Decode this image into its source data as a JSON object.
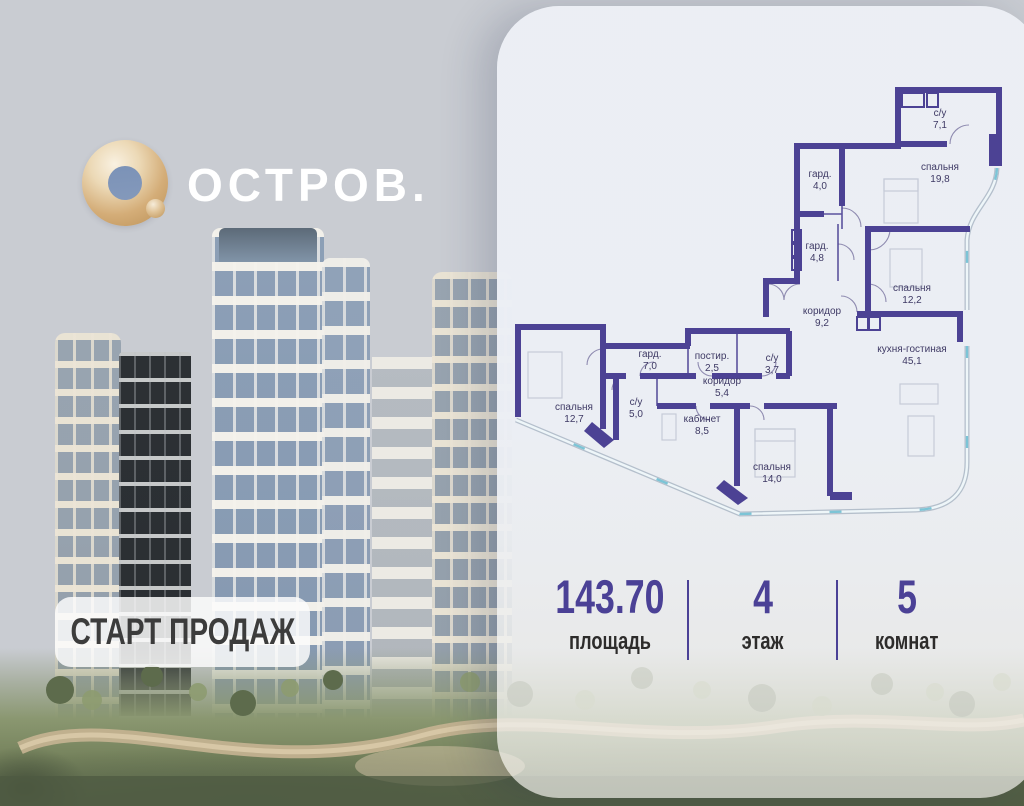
{
  "logo": {
    "brand_mark": "О.",
    "brand_name": "ОСТРОВ."
  },
  "badge": {
    "label": "СТАРТ ПРОДАЖ"
  },
  "stats": {
    "items": [
      {
        "value": "143.70",
        "label": "площадь"
      },
      {
        "value": "4",
        "label": "этаж"
      },
      {
        "value": "5",
        "label": "комнат"
      }
    ]
  },
  "floor_plan": {
    "rooms": [
      {
        "name": "с/у",
        "area": "7,1"
      },
      {
        "name": "спальня",
        "area": "19,8"
      },
      {
        "name": "гард.",
        "area": "4,0"
      },
      {
        "name": "гард.",
        "area": "4,8"
      },
      {
        "name": "коридор",
        "area": "9,2"
      },
      {
        "name": "спальня",
        "area": "12,2"
      },
      {
        "name": "кухня-гостиная",
        "area": "45,1"
      },
      {
        "name": "гард.",
        "area": "7,0"
      },
      {
        "name": "постир.",
        "area": "2,5"
      },
      {
        "name": "с/у",
        "area": "3,7"
      },
      {
        "name": "коридор",
        "area": "5,4"
      },
      {
        "name": "с/у",
        "area": "5,0"
      },
      {
        "name": "спальня",
        "area": "12,7"
      },
      {
        "name": "кабинет",
        "area": "8,5"
      },
      {
        "name": "спальня",
        "area": "14,0"
      }
    ]
  },
  "colors": {
    "accent_purple": "#4b4196",
    "wall_purple": "#4c4294",
    "glazing_teal": "#7cc4d6",
    "logo_gold": "#cfa878"
  }
}
